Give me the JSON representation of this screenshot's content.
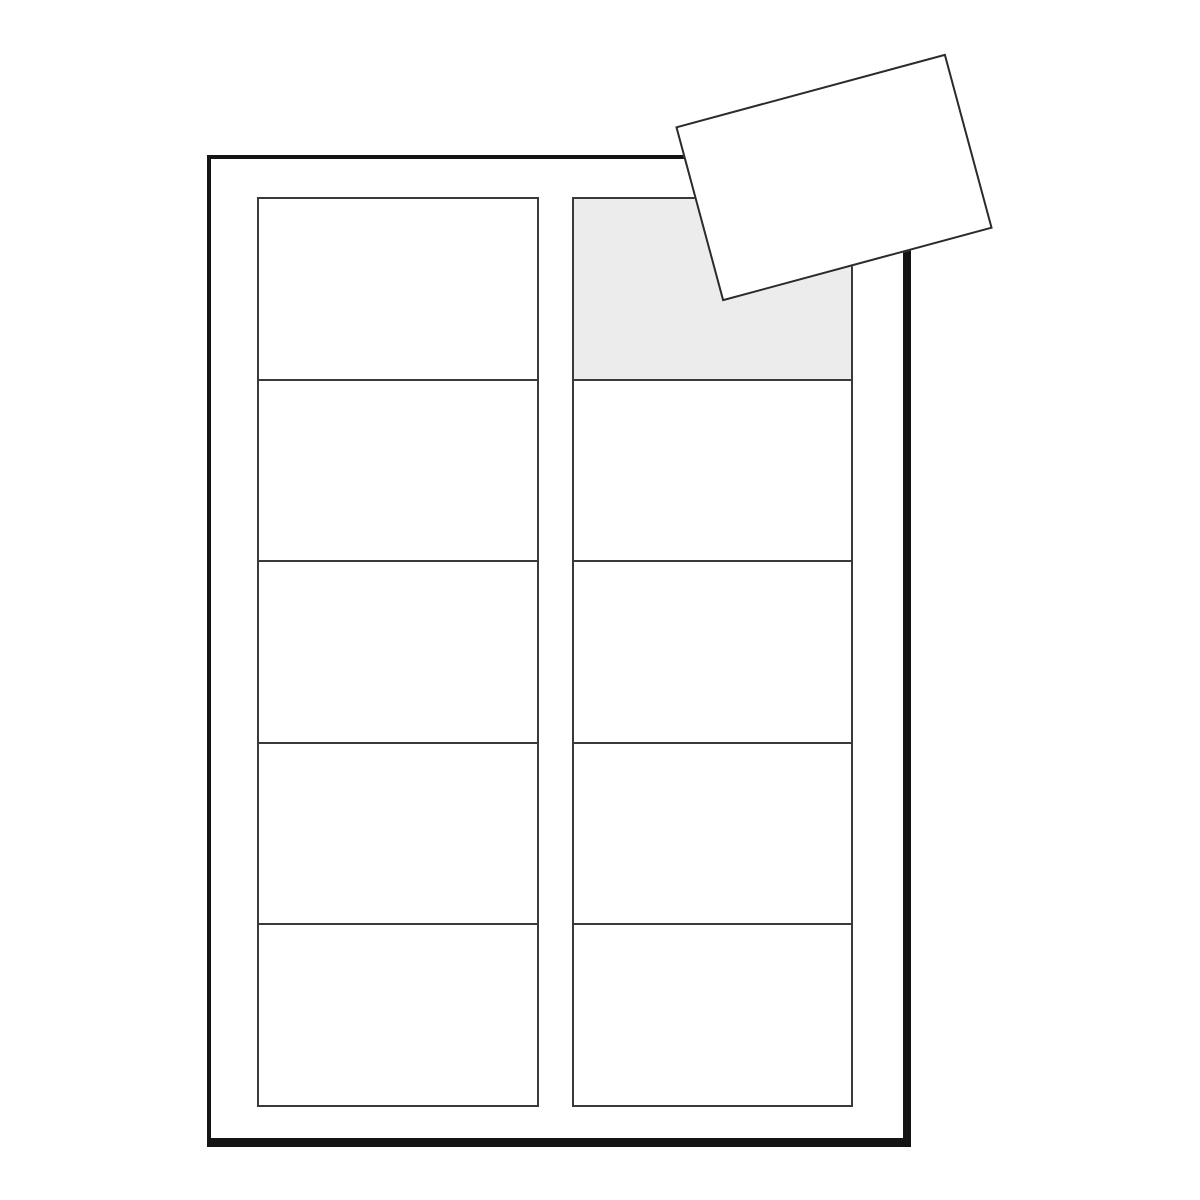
{
  "scene": {
    "kind": "blank-business-card-label-sheet-illustration",
    "background_color": "#ffffff"
  },
  "sheet": {
    "fill_color": "#ffffff",
    "border_color": "#141414",
    "grid": {
      "columns": 2,
      "rows": 5,
      "cells_total": 10,
      "line_color": "#3a3a3a",
      "cell_fill_color": "#ffffff",
      "highlighted_cell": {
        "column_index": 1,
        "row_index": 0,
        "fill_color": "#ececec"
      }
    }
  },
  "detached_card": {
    "fill_color": "#ffffff",
    "border_color": "#2b2b2b",
    "rotation_deg": -15.1
  }
}
